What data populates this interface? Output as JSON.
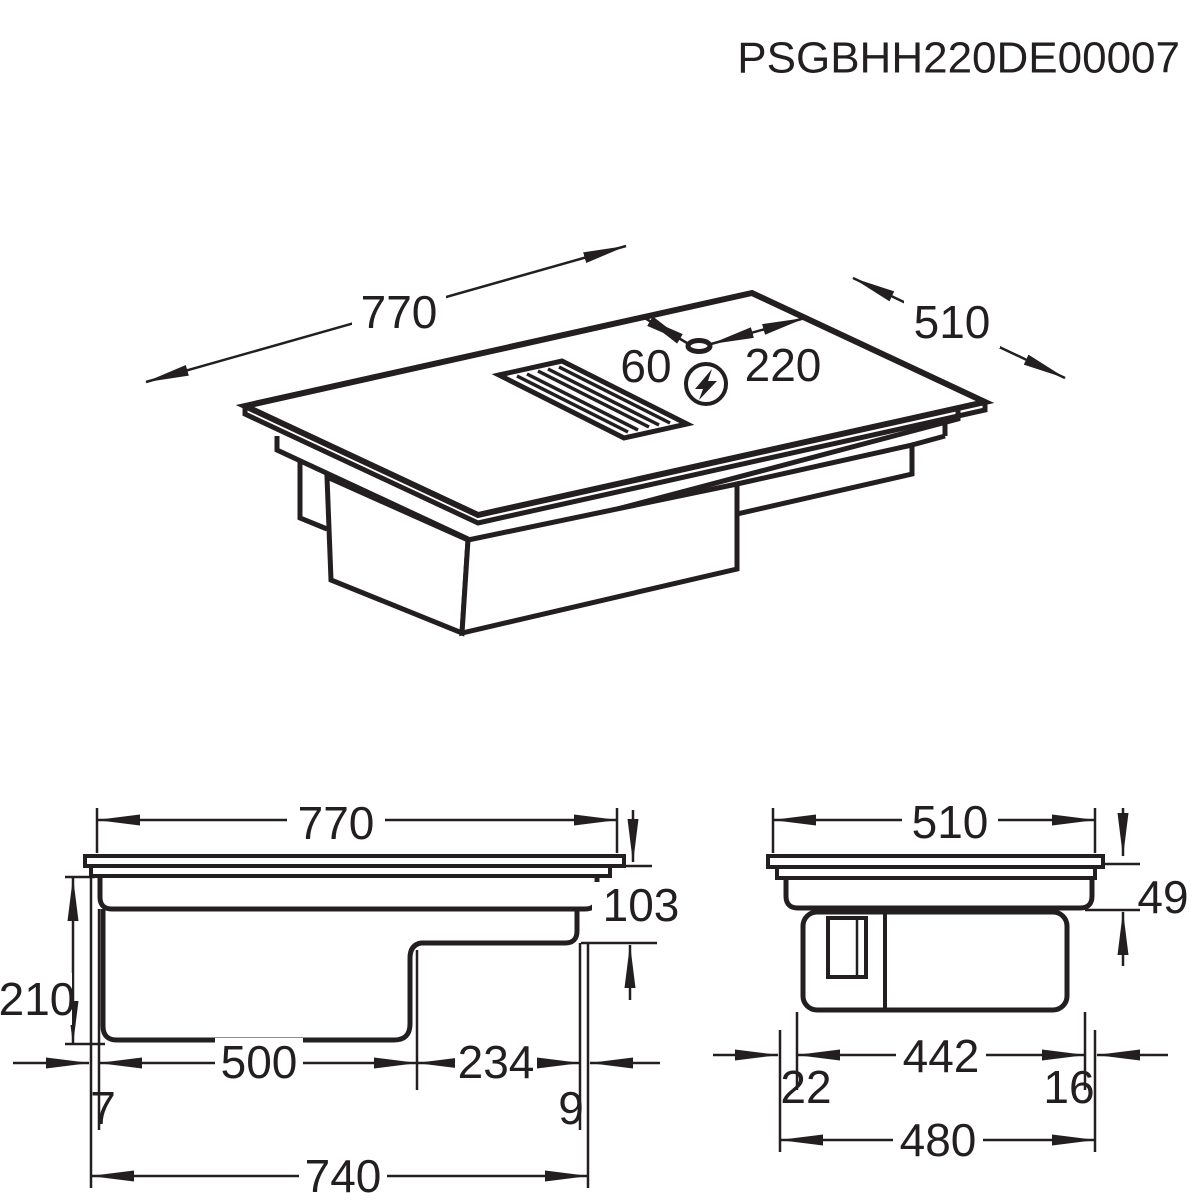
{
  "title": "PSGBHH220DE00007",
  "colors": {
    "line": "#231f20",
    "background": "#ffffff",
    "label_background": "#ffffff"
  },
  "views": {
    "isometric": {
      "label": "isometric-top-view",
      "dims": {
        "width": "770",
        "depth": "510",
        "gland_offset_back": "60",
        "gland_offset_right": "220"
      },
      "icons": {
        "power_connection": "lightning-bolt-circle-icon",
        "cable_gland": "cable-gland-ellipse",
        "vent": "extractor-grille"
      }
    },
    "front": {
      "label": "front-elevation-view",
      "dims": {
        "glass_width": "770",
        "total_height": "210",
        "right_section_height": "103",
        "box_width": "500",
        "right_section_width": "234",
        "left_inset": "7",
        "right_inset": "9",
        "casing_width": "740"
      }
    },
    "side": {
      "label": "side-elevation-view",
      "dims": {
        "glass_depth": "510",
        "rim_height": "49",
        "box_depth": "442",
        "front_inset": "22",
        "back_inset": "16",
        "casing_depth": "480"
      }
    }
  }
}
